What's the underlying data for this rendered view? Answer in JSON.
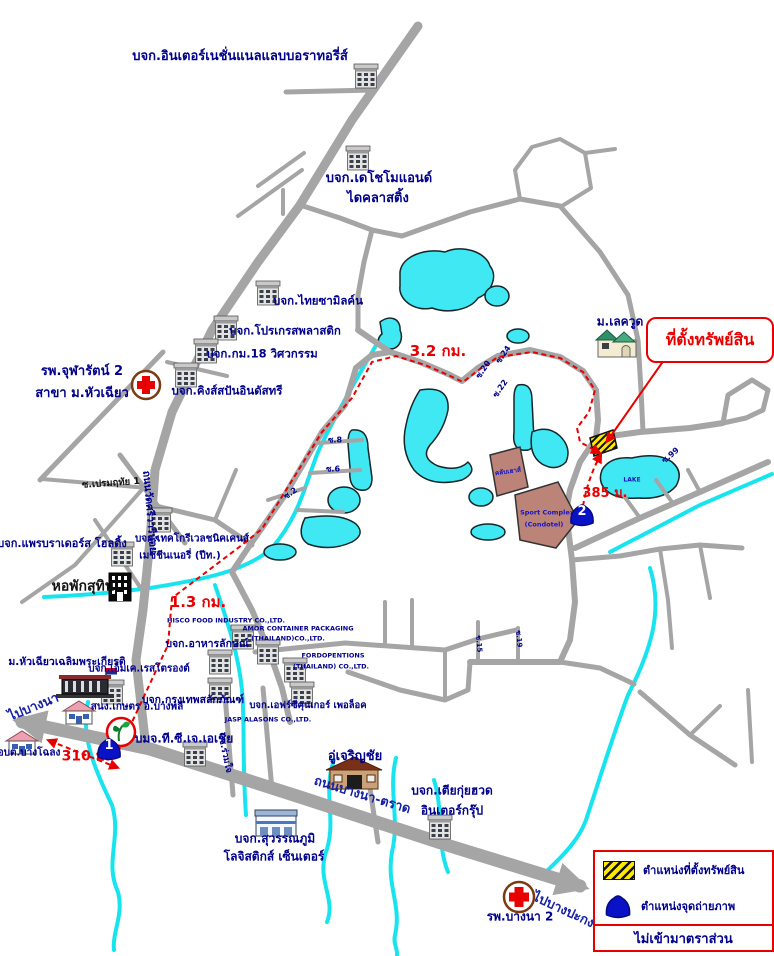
{
  "map": {
    "callout": {
      "text": "ที่ตั้งทรัพย์สิน"
    },
    "legend": {
      "items": [
        {
          "icon": "property-location-swatch",
          "label": "ตำแหน่งที่ตั้งทรัพย์สิน"
        },
        {
          "icon": "photo-point-icon",
          "label": "ตำแหน่งจุดถ่ายภาพ"
        }
      ],
      "note": "ไม่เข้ามาตราส่วน"
    },
    "markers": [
      {
        "number": "1",
        "x": 109,
        "y": 749
      },
      {
        "number": "2",
        "x": 582,
        "y": 515
      }
    ],
    "labels": [
      {
        "text": "บจก.อินเตอร์เนชั่นแนลแลบบอราทอรี่ส์",
        "x": 240,
        "y": 57,
        "size": 13
      },
      {
        "text": "บจก.เดโชโมแอนด์",
        "x": 379,
        "y": 179,
        "size": 13
      },
      {
        "text": "ไดคลาสติ้ง",
        "x": 378,
        "y": 199,
        "size": 13
      },
      {
        "text": "บจก.ไทยซามิลค์น",
        "x": 318,
        "y": 301,
        "size": 11.5
      },
      {
        "text": "บจก.โปรเกรสพลาสติก",
        "x": 285,
        "y": 331,
        "size": 11.5
      },
      {
        "text": "บจก.กม.18 วิศวกรรม",
        "x": 262,
        "y": 354,
        "size": 11.5
      },
      {
        "text": "บจก.คิงส์สปันอินดัสทรี",
        "x": 227,
        "y": 391,
        "size": 11.5
      },
      {
        "text": "รพ.จุฬารัตน์ 2",
        "x": 82,
        "y": 372,
        "size": 13
      },
      {
        "text": "สาขา ม.หัวเฉียว",
        "x": 82,
        "y": 394,
        "size": 13
      },
      {
        "text": "3.2 กม.",
        "x": 438,
        "y": 351,
        "size": 15,
        "color": "#e80000"
      },
      {
        "text": "ม.เลควูด",
        "x": 620,
        "y": 322,
        "size": 12
      },
      {
        "text": "ซ.เปรมฤทัย 1",
        "x": 111,
        "y": 484,
        "size": 9.5,
        "color": "#111111",
        "rot": -4
      },
      {
        "text": "ถนนวัดศรีวารีน้อย",
        "x": 149,
        "y": 512,
        "size": 10.5,
        "rot": 85
      },
      {
        "text": "บจก.แพรบราเดอร์ส โฮลดิ้ง",
        "x": 62,
        "y": 544,
        "size": 11
      },
      {
        "text": "บจก.เทคโกรีเวลชนิคเคนส์",
        "x": 192,
        "y": 539,
        "size": 10
      },
      {
        "text": "เมชชีนเนอรี่ (ปีท.)",
        "x": 180,
        "y": 556,
        "size": 10
      },
      {
        "text": "หอพักสุทิน",
        "x": 83,
        "y": 587,
        "size": 14,
        "color": "#111111"
      },
      {
        "text": "1.3 กม.",
        "x": 198,
        "y": 602,
        "size": 15,
        "color": "#e80000"
      },
      {
        "text": "HISCO FOOD INDUSTRY CO.,LTD.",
        "x": 226,
        "y": 621,
        "size": 6.5
      },
      {
        "text": "บจก.อาหารลักษณ์",
        "x": 207,
        "y": 645,
        "size": 10.5
      },
      {
        "text": "AMOR CONTAINER PACKAGING",
        "x": 298,
        "y": 629,
        "size": 6.5
      },
      {
        "text": "(THAILAND)CO.,LTD.",
        "x": 288,
        "y": 639,
        "size": 6.5
      },
      {
        "text": "FORDOPENTIONS",
        "x": 333,
        "y": 656,
        "size": 6.5
      },
      {
        "text": "(THAILAND) CO.,LTD.",
        "x": 331,
        "y": 667,
        "size": 6.5
      },
      {
        "text": "บจก.กรุงเทพสลักภัณฑ์",
        "x": 193,
        "y": 701,
        "size": 10.5
      },
      {
        "text": "บจก.เอฟร์ซีคุนเกอร์ เพอล็อค",
        "x": 308,
        "y": 706,
        "size": 9.5
      },
      {
        "text": "JASP ALASONS CO.,LTD.",
        "x": 268,
        "y": 720,
        "size": 6.5
      },
      {
        "text": "บมจ.ที.ซี.เจ.เอเชีย",
        "x": 184,
        "y": 739,
        "size": 12
      },
      {
        "text": "ซ.ร่วมใจ",
        "x": 224,
        "y": 756,
        "size": 9,
        "rot": 78
      },
      {
        "text": "อู่เจริญชัย",
        "x": 355,
        "y": 757,
        "size": 13
      },
      {
        "text": "ม.หัวเฉียวเฉลิมพระเกียรติ",
        "x": 67,
        "y": 663,
        "size": 10.5
      },
      {
        "text": "ไปบางนา",
        "x": 34,
        "y": 708,
        "size": 13,
        "rot": -22,
        "color": "#1520A6"
      },
      {
        "text": "สนง.เกษตร อ.บางพลี",
        "x": 137,
        "y": 707,
        "size": 10
      },
      {
        "text": "บจก.เอ็มเค.เรสโตรองต์",
        "x": 139,
        "y": 669,
        "size": 10
      },
      {
        "text": "อบต.บางโฉลง",
        "x": 29,
        "y": 753,
        "size": 10
      },
      {
        "text": "310 ม.",
        "x": 86,
        "y": 757,
        "size": 14,
        "color": "#e80000"
      },
      {
        "text": "ถนนบางนา-ตราด",
        "x": 362,
        "y": 796,
        "size": 13,
        "rot": 17,
        "color": "#1520A6"
      },
      {
        "text": "บจก.เตียกุ่ยฮวด",
        "x": 452,
        "y": 791,
        "size": 12
      },
      {
        "text": "อินเตอร์กรุ๊ป",
        "x": 452,
        "y": 811,
        "size": 12
      },
      {
        "text": "บจก.สุวรรณภูมิ",
        "x": 275,
        "y": 839,
        "size": 12
      },
      {
        "text": "โลจิสติกส์ เซ็นเตอร์",
        "x": 274,
        "y": 857,
        "size": 12
      },
      {
        "text": "รพ.บางนา 2",
        "x": 520,
        "y": 917,
        "size": 12
      },
      {
        "text": "ไปบางปะกง",
        "x": 563,
        "y": 911,
        "size": 13,
        "rot": 25,
        "color": "#1520A6"
      },
      {
        "text": "385 ม.",
        "x": 605,
        "y": 494,
        "size": 13,
        "color": "#e80000"
      },
      {
        "text": "LAKE",
        "x": 632,
        "y": 481,
        "size": 6,
        "color": "#1515C0"
      },
      {
        "text": "ซ.8",
        "x": 335,
        "y": 441,
        "size": 8
      },
      {
        "text": "ซ.6",
        "x": 333,
        "y": 470,
        "size": 8
      },
      {
        "text": "ซ.2",
        "x": 291,
        "y": 494,
        "size": 8,
        "rot": -35
      },
      {
        "text": "ซ.24",
        "x": 504,
        "y": 355,
        "size": 8,
        "rot": -55
      },
      {
        "text": "ซ.20",
        "x": 484,
        "y": 370,
        "size": 8,
        "rot": -55
      },
      {
        "text": "ซ.22",
        "x": 501,
        "y": 389,
        "size": 8,
        "rot": -55
      },
      {
        "text": "ซ.99",
        "x": 671,
        "y": 456,
        "size": 8,
        "rot": -40
      },
      {
        "text": "ซ.15",
        "x": 478,
        "y": 644,
        "size": 7,
        "rot": 85
      },
      {
        "text": "ซ.19",
        "x": 518,
        "y": 639,
        "size": 7,
        "rot": 85
      },
      {
        "text": "คลับเฮาส์",
        "x": 508,
        "y": 472,
        "size": 6.5,
        "color": "#1515C0",
        "rot": -8
      },
      {
        "text": "Sport Complex",
        "x": 547,
        "y": 513,
        "size": 6.5,
        "color": "#1515C0"
      },
      {
        "text": "(Condotel)",
        "x": 544,
        "y": 525,
        "size": 6.5,
        "color": "#1515C0"
      }
    ],
    "colors": {
      "road": "#a5a5a5",
      "water": "#3fe8f2",
      "route": "#e80000",
      "label": "#00008B",
      "complex_fill": "#bc8478",
      "marker_blue": "#0a12c8",
      "property_yellow": "#ffe800"
    }
  }
}
